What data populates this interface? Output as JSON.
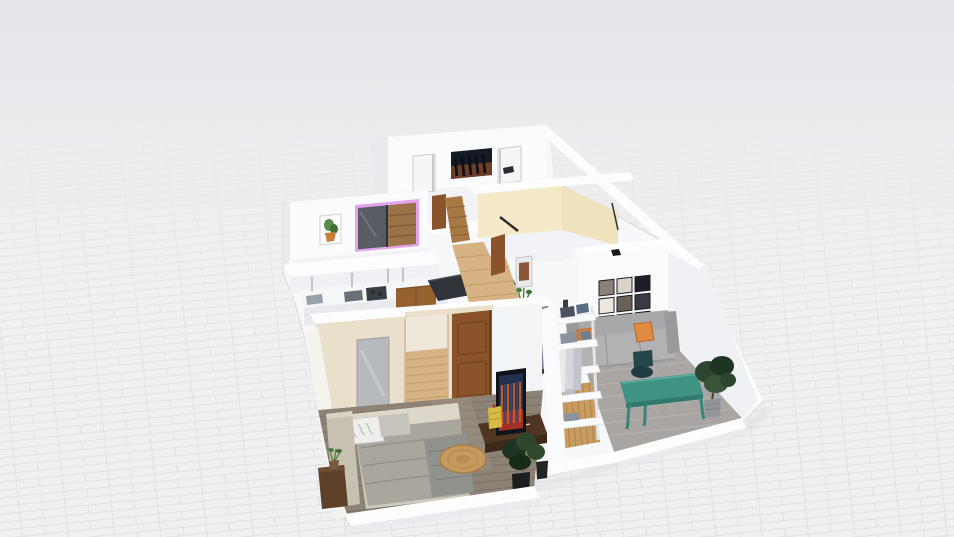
{
  "palette": {
    "bg_top": "#e5e5ea",
    "bg_floor": "#f1f1f3",
    "grid_line": "#dcdce1",
    "mass_white": "#f7f8fa",
    "wall_white": "#fafbfd",
    "wall_top": "#fdfdfe",
    "wall_shade": "#e9ebef",
    "wall_face": "#eff1f4",
    "wall_cream": "#f5e9c8",
    "wall_cream_dark": "#efe2bd",
    "bedroom_wall": "#e9dfca",
    "floor_white": "#f2f3f6",
    "floor_tile": "#a8a5a2",
    "tile_line": "#b9b6b3",
    "floor_wood_rustic": "#8d8276",
    "wood_rustic_line": "#7b7064",
    "floor_wood_light": "#d7b384",
    "wood_light_line": "#c09c66",
    "floor_wood_closet": "#c89b60",
    "wood_closet_line": "#a9814a",
    "accent_purple": "#e2a3ef",
    "wardrobe_glass": "#585c63",
    "wardrobe_wood": "#9a7348",
    "door_brown": "#8a5329",
    "door_brown_dark": "#774621",
    "stair_wood": "#a87844",
    "poster_dark": "#141a26",
    "poster_glow": "#8a4a28",
    "tv_navy": "#22304e",
    "tv_red": "#a03028",
    "sofa_back": "#a8a8ab",
    "sofa_seat": "#b2b2b4",
    "sofa_base": "#97979a",
    "pillow_orange": "#d9823e",
    "chair_teal_dark": "#25464b",
    "desk_teal": "#3f9383",
    "desk_teal_dark": "#2f7a6c",
    "plant_green": "#2c4630",
    "plant_green_dark": "#1f3524",
    "plant_green_light": "#4f7f3f",
    "pot_grey": "#92959a",
    "pot_black": "#1c1d1f",
    "rug_tan": "#c69a5e",
    "rug_ring": "#a87e48",
    "bed_duvet": "#a9a69e",
    "bed_sheet": "#dcd7ca",
    "bed_head": "#c7c1b2",
    "bed_blanket": "#90938d",
    "pillow_white": "#eeeeec",
    "pillow_grey": "#c6c3ba",
    "mirror_grey": "#b6babd",
    "mirror_dark_frame": "#33373d",
    "mirror_glass": "#787f88",
    "nightstand_wood": "#5e3f28",
    "console_wood": "#503622",
    "counter_dark": "#30343a",
    "cabinet_wood": "#96602f",
    "side_table_yellow": "#d9ba45",
    "art_green": "#5a8a4a",
    "art_pot_orange": "#c87f3a",
    "cloth_blue": "#5a6d85",
    "cloth_grey": "#8a93a0",
    "cloth_dark": "#4a5160",
    "gallery": [
      "#8a8278",
      "#d8d2c8",
      "#1e1e26",
      "#ece8dd",
      "#6a6258",
      "#3a3a42",
      "#c9c3b6",
      "#f1eee6",
      "#44403a"
    ]
  },
  "scene": {
    "type": "3d-floorplan-render",
    "rooms": [
      {
        "name": "media-room",
        "objects": [
          "movie-poster",
          "white-door",
          "white-door",
          "wall-lamp"
        ]
      },
      {
        "name": "wardrobe-room",
        "objects": [
          "botanical-art",
          "sliding-door-wardrobe-purple-led"
        ]
      },
      {
        "name": "kitchen",
        "objects": [
          "counter-with-faucets",
          "sink",
          "cooktop",
          "wood-cabinet",
          "dark-counter",
          "dark-counter"
        ]
      },
      {
        "name": "cream-room",
        "objects": [
          "wood-door-frame",
          "framed-picture"
        ]
      },
      {
        "name": "hallway",
        "objects": [
          "wood-stairs",
          "wood-door",
          "potted-plant",
          "white-side-table"
        ]
      },
      {
        "name": "office-living-room",
        "objects": [
          "gallery-wall",
          "wall-lamp",
          "grey-sofa",
          "orange-pillow",
          "orange-pillow",
          "dark-teal-chair",
          "teal-desk",
          "potted-plant"
        ]
      },
      {
        "name": "walk-in-closet",
        "objects": [
          "leaning-mirror",
          "open-shelving",
          "hanging-clothes",
          "folded-clothes"
        ]
      },
      {
        "name": "bedroom",
        "objects": [
          "double-bed",
          "headboard",
          "patterned-pillow",
          "grey-pillow",
          "nightstand-with-plant",
          "wall-mirror-panel",
          "door-opening",
          "wood-door",
          "round-jute-rug",
          "tv-console",
          "leaning-tv-poster",
          "yellow-side-table",
          "potted-plants"
        ]
      }
    ]
  }
}
